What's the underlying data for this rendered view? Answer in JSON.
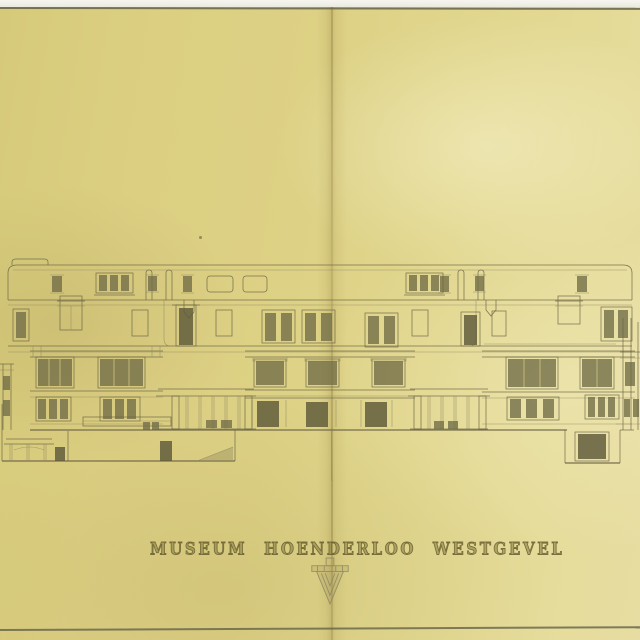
{
  "title_block": {
    "title": "MUSEUM HOENDERLOO WESTGEVEL"
  },
  "icons": {
    "monogram": "architect-monogram-icon"
  },
  "colors": {
    "photo_background": "#f3f2ec",
    "edge_line": "#60604346",
    "paper": "#ddd185",
    "ink": "#6b6446",
    "ink_light": "#8f8760",
    "window_fill": "#716b46",
    "window_dark": "#5e5939",
    "wash": "#9a9060",
    "fold_crease": "#a8984e"
  }
}
